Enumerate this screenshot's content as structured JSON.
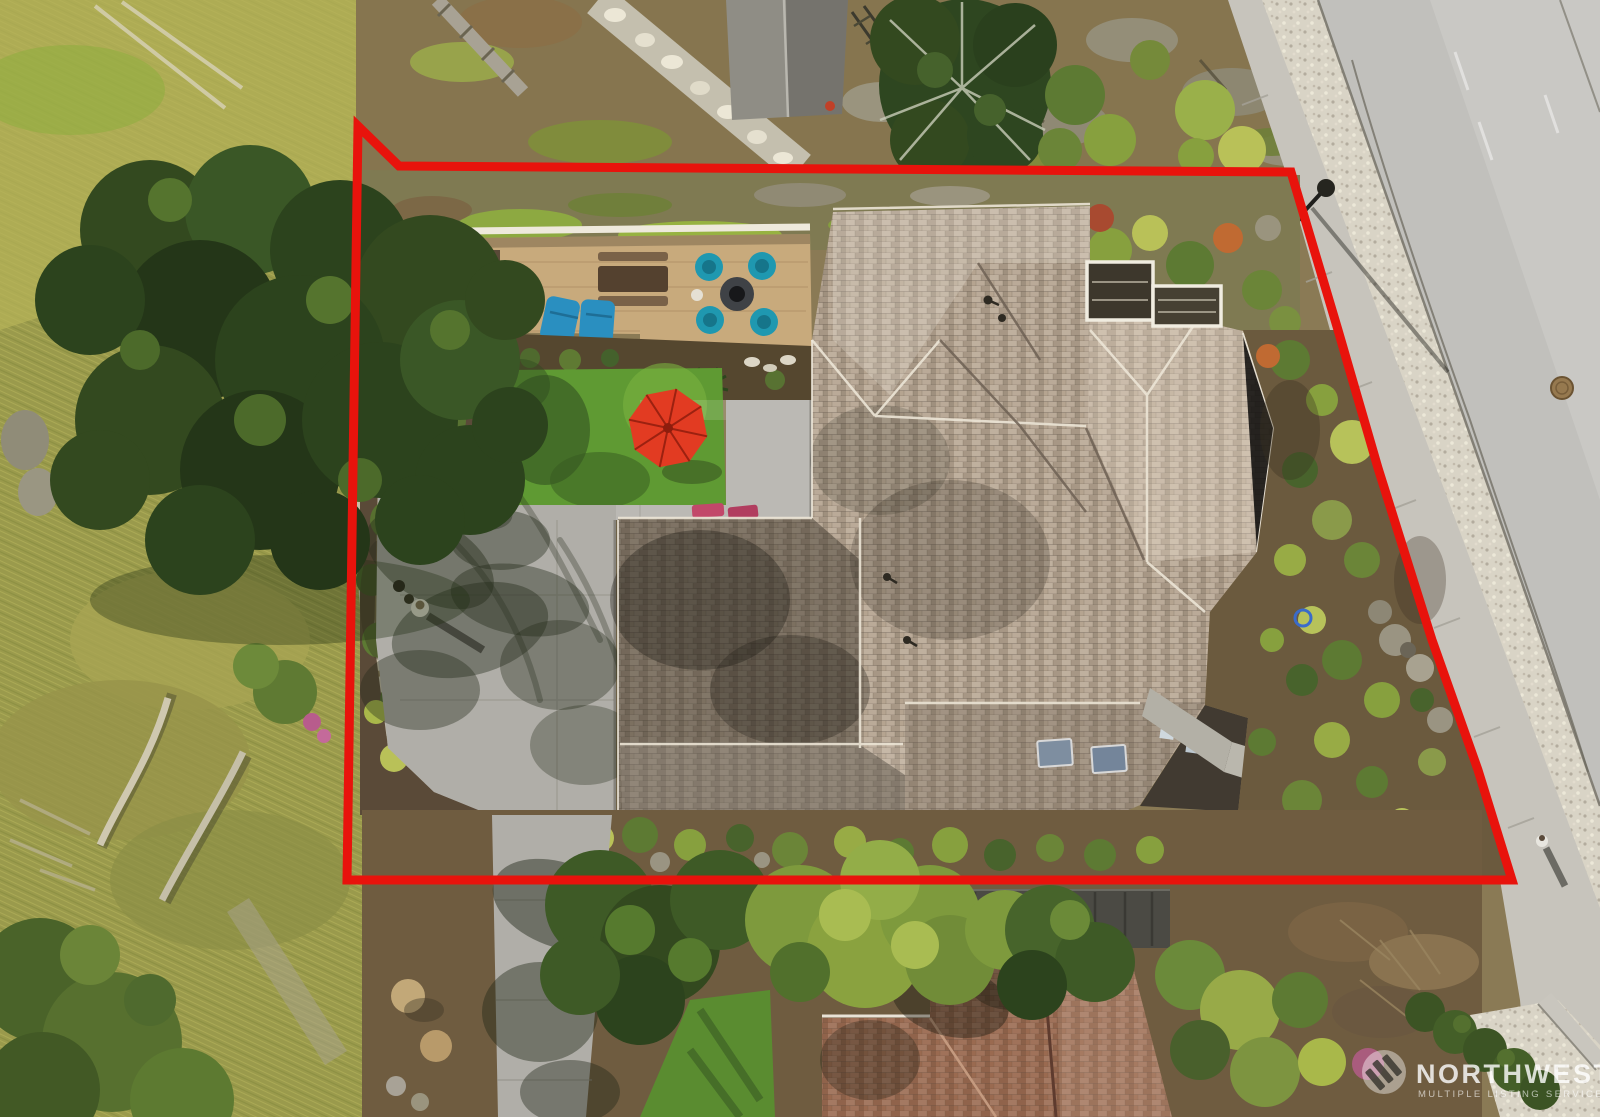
{
  "image": {
    "kind": "aerial-drone-photo",
    "subject": "Overhead view of a residential lot with house, patio, gardens, street at upper right, and a red property-boundary outline drawn over the photo",
    "width_px": 1600,
    "height_px": 1117
  },
  "overlay": {
    "boundary_color": "#e8130c",
    "boundary_stroke_px": 9,
    "boundary_points": "358,126 399,166 1291,172 1338,330 1378,468 1432,640 1478,770 1512,880 347,880"
  },
  "watermark": {
    "title": "NORTHWEST",
    "subtitle": "MULTIPLE LISTING SERVICE",
    "logo": "three-peaks-in-circle",
    "color": "#ffffff"
  },
  "palette": {
    "boundary": "#e8130c",
    "roof": "#b5a490",
    "roof-shadow": "#5e5448",
    "deck": "#c8aa7c",
    "teal-furniture": "#1f98b0",
    "umbrella": "#e23b22",
    "lawn": "#5f9a33",
    "patio": "#b0aea8",
    "road": "#c1c0bc",
    "sidewalk": "#c7c4bc",
    "gravel": "#d9d4c6",
    "conifer": "#33491f",
    "meadow": "#9a9a4c",
    "soil": "#6f5c40",
    "neighbor-roof": "#9a6a50",
    "watermark": "#ffffff"
  },
  "scene": {
    "features": [
      "red lot boundary polygon overlay",
      "gray-tan shingled hip roof of main house",
      "covered deck with white pergola beam and teal patio furniture set around fire table",
      "blue chaise lounges",
      "red patio umbrella on green lawn",
      "large concrete patio with tree shadows and a person standing",
      "tall conifer trees on left hillside meadow with fallen logs",
      "asphalt street with sidewalk, gravel strip, street lamp and manhole at upper right",
      "rock garden with shrubs and boulders along east side",
      "neighboring brown-roof house at bottom",
      "NWMLS watermark at lower right"
    ]
  }
}
